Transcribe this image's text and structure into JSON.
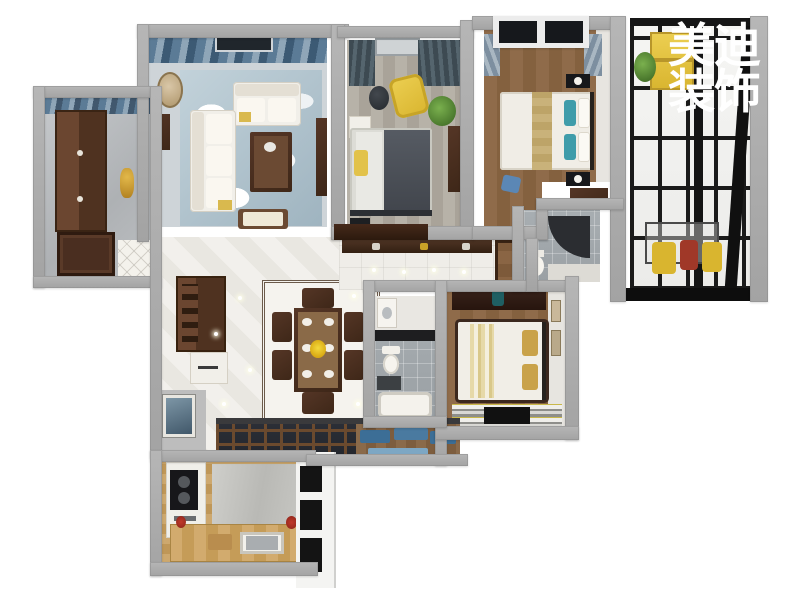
{
  "image": {
    "kind": "3d-floorplan-render",
    "background": "#ffffff"
  },
  "watermark": {
    "line1": "美迪",
    "line2": "装饰",
    "color": "#ffffff"
  },
  "palette": {
    "wall_gray": "#aaaaaa",
    "wood_dark": "#4a2e20",
    "wood_floor": "#8a6544",
    "oak_kitchen": "#c9a36b",
    "marble_white": "#edebe6",
    "marble_gray": "#b9bcbe",
    "tile_gray": "#9aa0a4",
    "steel_frame_black": "#161616",
    "sofa_white": "#f1eee7",
    "curtain_blue": "#5b7b96",
    "curtain_slate": "#3d4a52",
    "duvet_gray": "#4b5058",
    "accent_yellow": "#e5c445",
    "accent_teal": "#3f9caa",
    "bench_blue": "#4a7aa0",
    "accent_red": "#a03828",
    "plant_green": "#5a8f3c"
  },
  "rooms": [
    {
      "id": "living-room"
    },
    {
      "id": "middle-bedroom"
    },
    {
      "id": "master-bedroom"
    },
    {
      "id": "glass-balcony"
    },
    {
      "id": "foyer"
    },
    {
      "id": "dining-room"
    },
    {
      "id": "hallway"
    },
    {
      "id": "main-bathroom"
    },
    {
      "id": "shower-bathroom"
    },
    {
      "id": "south-bedroom"
    },
    {
      "id": "kitchen"
    },
    {
      "id": "laundry-balcony"
    }
  ]
}
